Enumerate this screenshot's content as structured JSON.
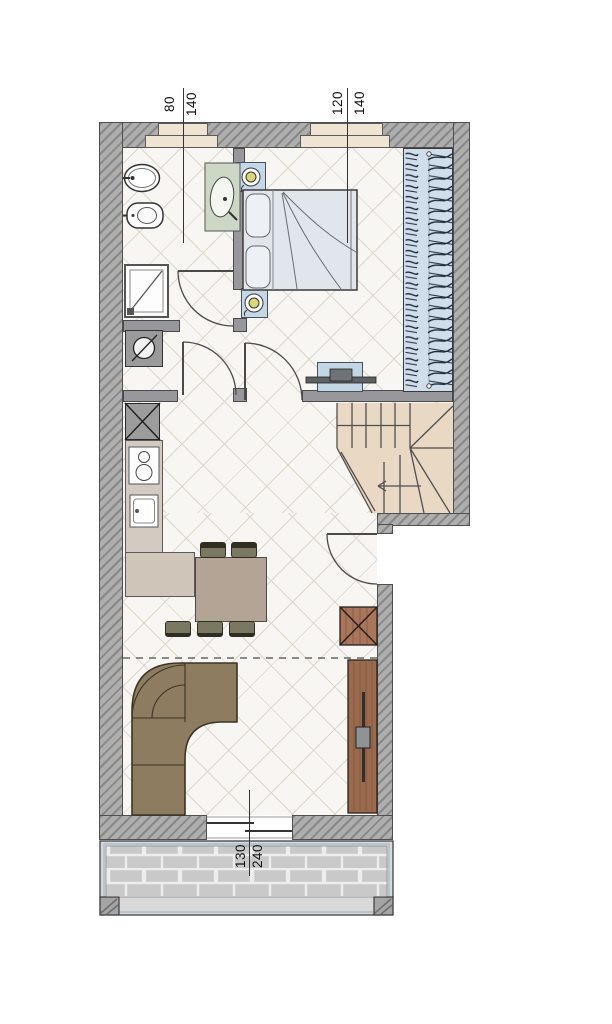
{
  "dimensions": {
    "bathroom_window": {
      "width": "80",
      "height": "140"
    },
    "bedroom_window": {
      "width": "120",
      "height": "140"
    },
    "terrace_door": {
      "width": "130",
      "height": "240"
    }
  },
  "colors": {
    "exterior_wall": "#aeaeae",
    "interior_wall": "#98989c",
    "wardrobe_blue": "#cfdeea",
    "stairs_beige": "#e9d8c3",
    "wood_brown": "#9b6a4d",
    "sofa_brown": "#8d7c5f",
    "table_taupe": "#b3a496",
    "terrace_brick": "#c9c9c9",
    "bed_fill": "#e1e6ec",
    "lamp_yellow": "#d8d878",
    "basin_green": "#cdd7c5"
  }
}
